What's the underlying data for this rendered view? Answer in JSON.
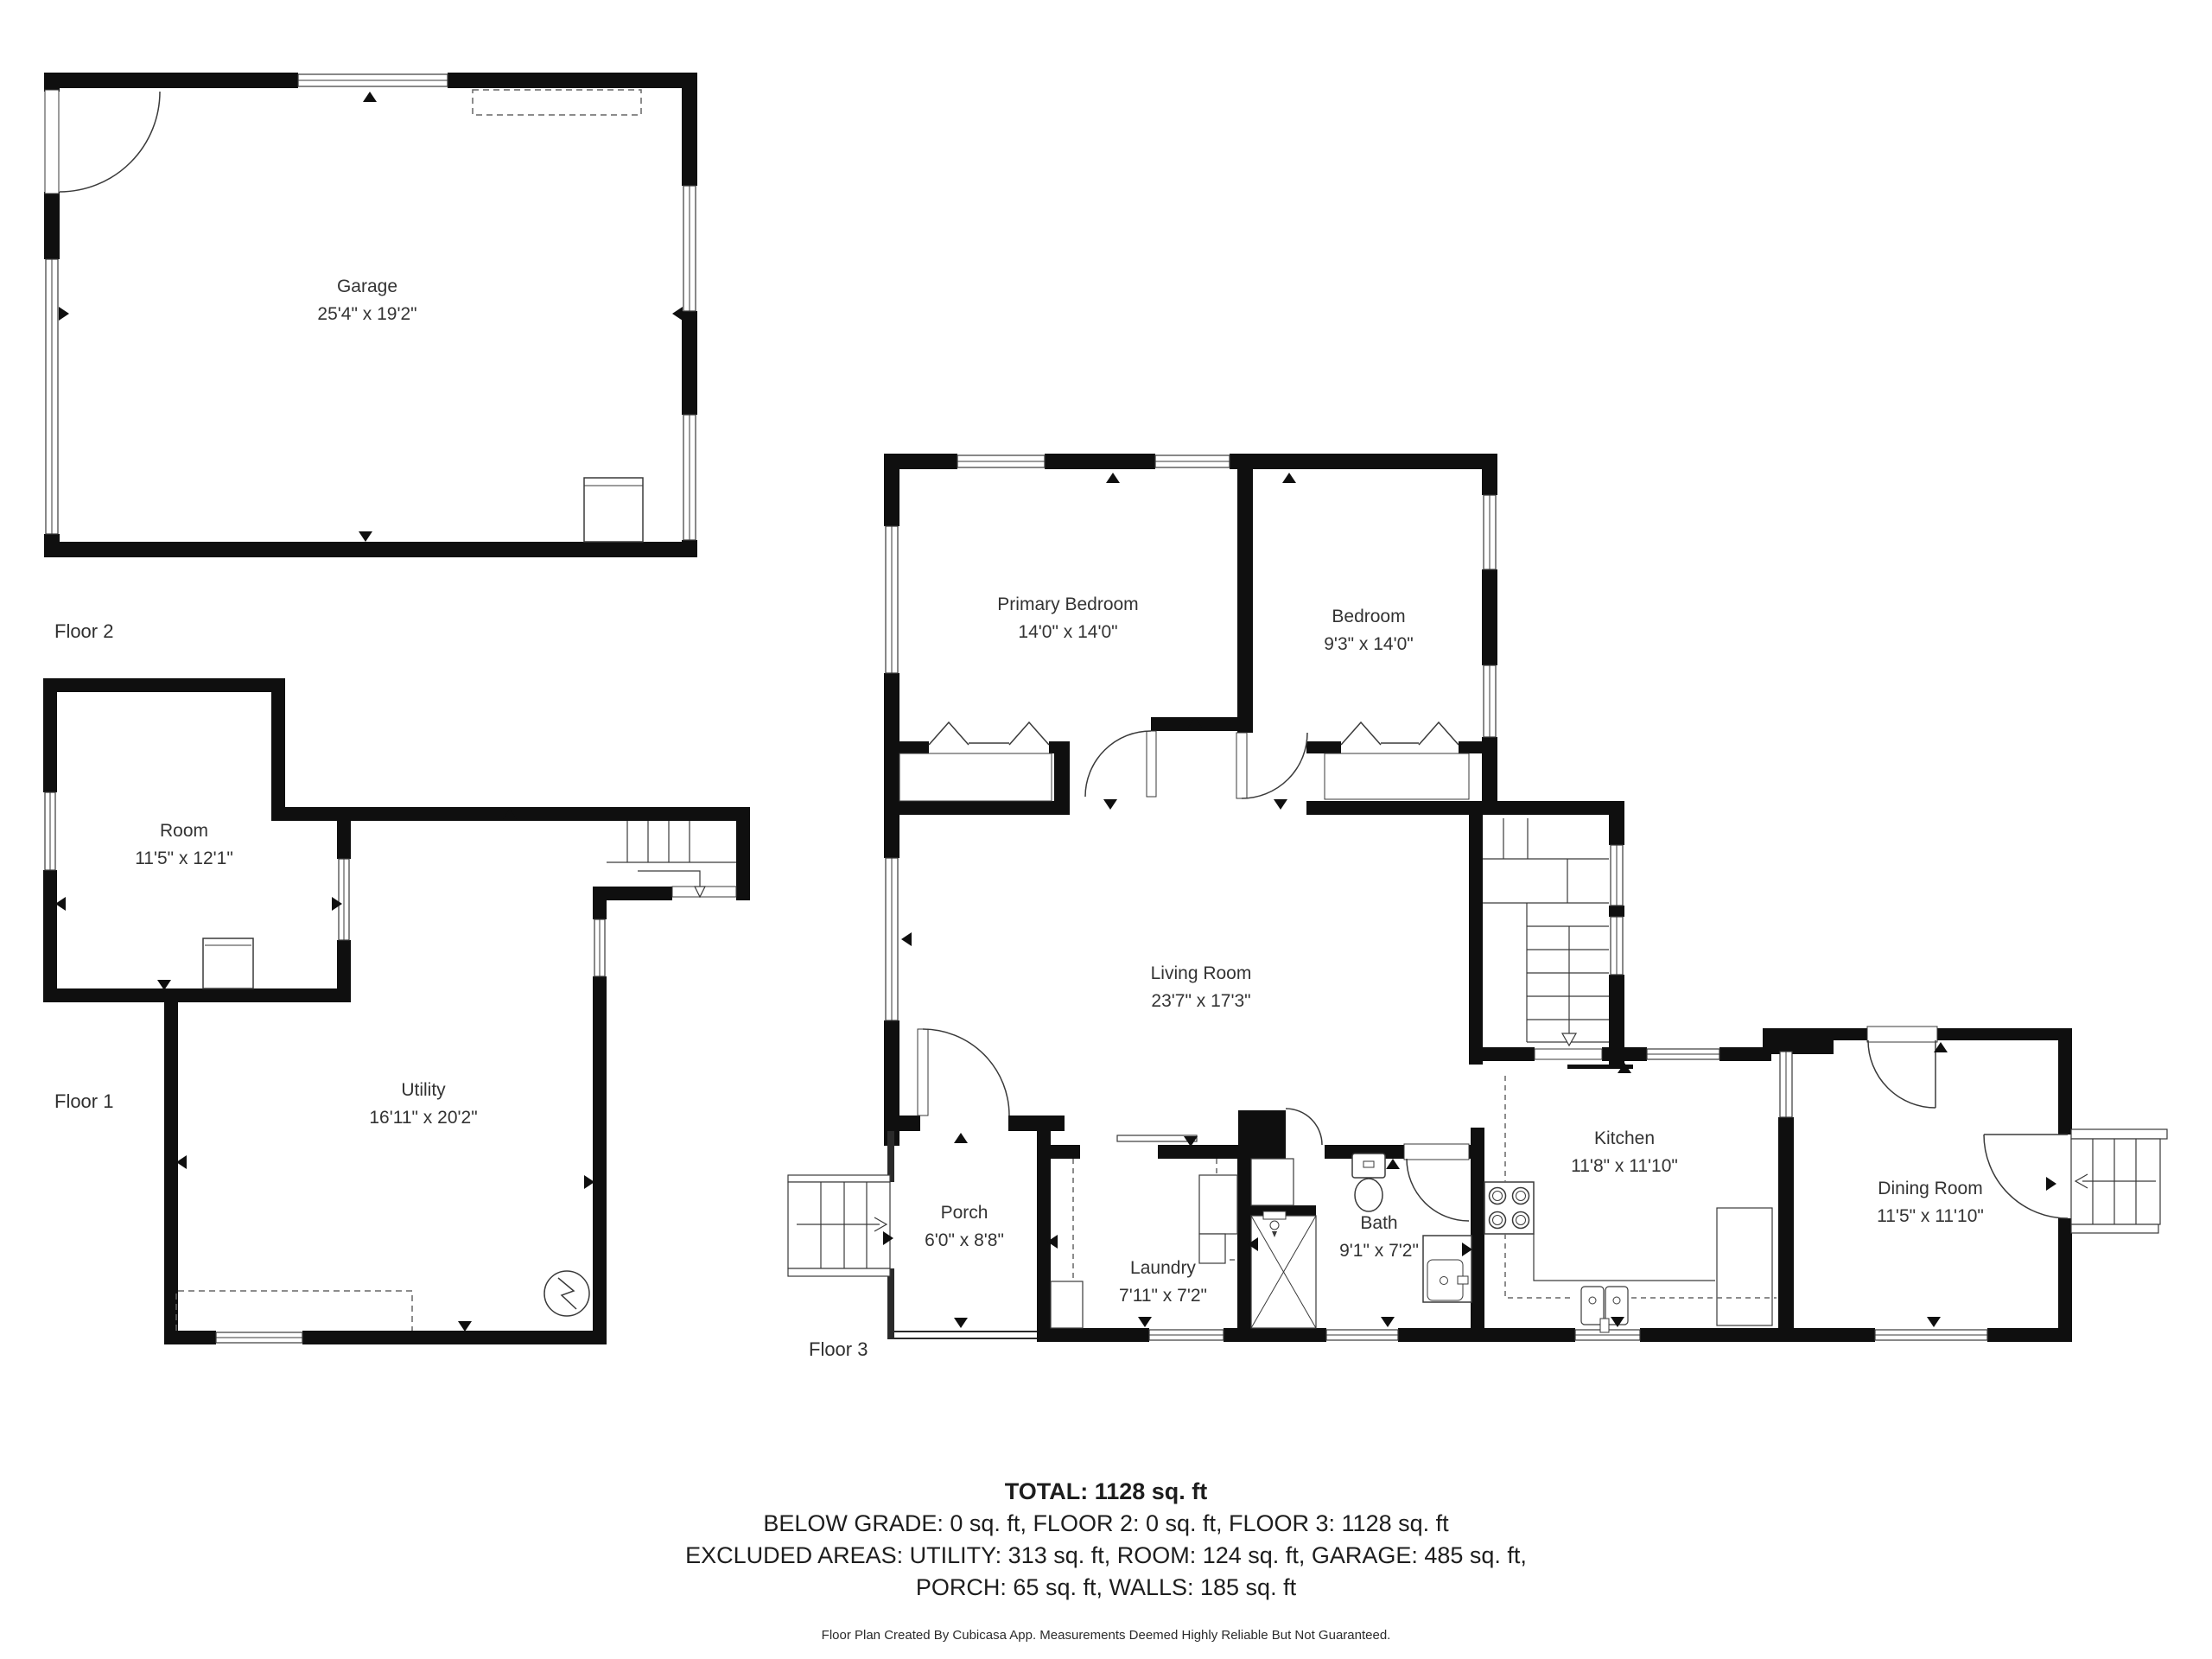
{
  "floors": [
    {
      "id": "floor2",
      "label": "Floor 2",
      "rooms": [
        {
          "name": "Garage",
          "dims": "25'4\" x 19'2\""
        }
      ]
    },
    {
      "id": "floor1",
      "label": "Floor 1",
      "rooms": [
        {
          "name": "Room",
          "dims": "11'5\" x 12'1\""
        },
        {
          "name": "Utility",
          "dims": "16'11\" x 20'2\""
        }
      ]
    },
    {
      "id": "floor3",
      "label": "Floor 3",
      "rooms": [
        {
          "name": "Primary Bedroom",
          "dims": "14'0\" x 14'0\""
        },
        {
          "name": "Bedroom",
          "dims": "9'3\" x 14'0\""
        },
        {
          "name": "Living Room",
          "dims": "23'7\" x 17'3\""
        },
        {
          "name": "Porch",
          "dims": "6'0\" x 8'8\""
        },
        {
          "name": "Laundry",
          "dims": "7'11\" x 7'2\""
        },
        {
          "name": "Bath",
          "dims": "9'1\" x 7'2\""
        },
        {
          "name": "Kitchen",
          "dims": "11'8\" x 11'10\""
        },
        {
          "name": "Dining Room",
          "dims": "11'5\" x 11'10\""
        }
      ]
    }
  ],
  "summary": {
    "total": "TOTAL: 1128 sq. ft",
    "line2": "BELOW GRADE: 0 sq. ft, FLOOR 2: 0 sq. ft, FLOOR 3: 1128 sq. ft",
    "line3": "EXCLUDED AREAS: UTILITY: 313 sq. ft, ROOM: 124 sq. ft, GARAGE: 485 sq. ft,",
    "line4": "PORCH: 65 sq. ft, WALLS: 185 sq. ft"
  },
  "footer": "Floor Plan Created By Cubicasa App. Measurements Deemed Highly Reliable But Not Guaranteed.",
  "colors": {
    "wall": "#0f0f0f",
    "line": "#3a3a3a",
    "text": "#333333"
  }
}
